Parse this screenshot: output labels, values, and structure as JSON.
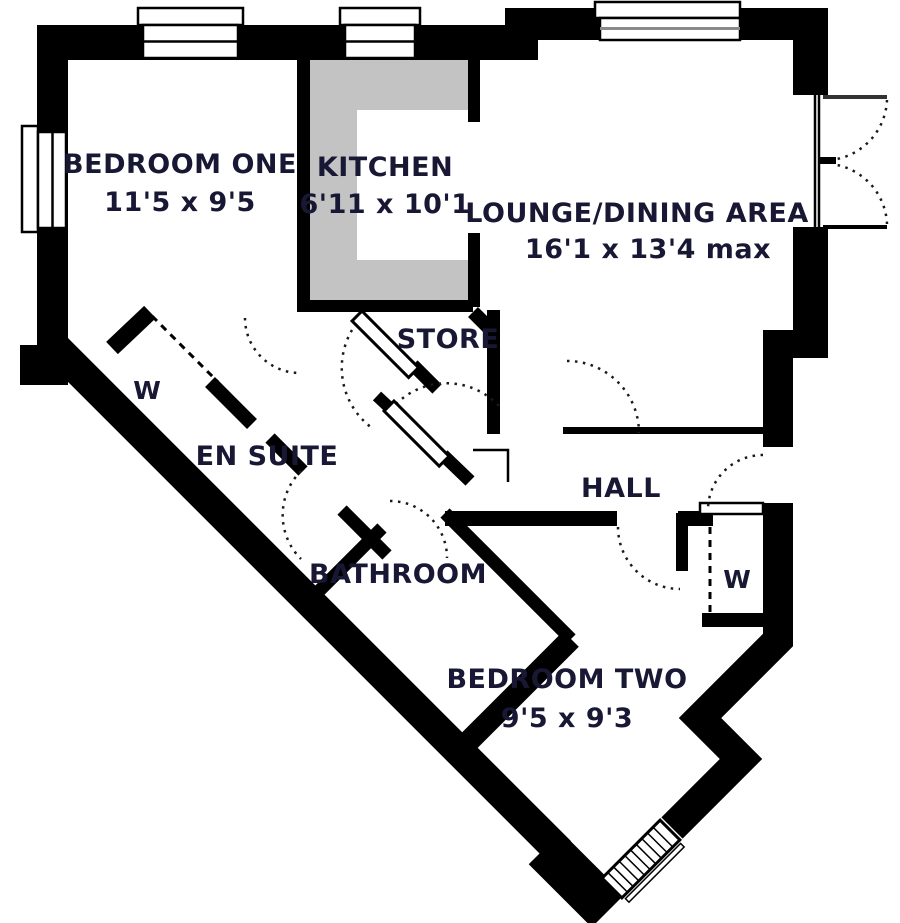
{
  "floorplan": {
    "rooms": {
      "bedroom_one": {
        "name": "BEDROOM ONE",
        "dimensions": "11'5 x 9'5"
      },
      "kitchen": {
        "name": "KITCHEN",
        "dimensions": "6'11 x 10'1"
      },
      "lounge": {
        "name": "LOUNGE/DINING AREA",
        "dimensions": "16'1 x 13'4 max"
      },
      "store": {
        "name": "STORE"
      },
      "en_suite": {
        "name": "EN SUITE"
      },
      "hall": {
        "name": "HALL"
      },
      "bathroom": {
        "name": "BATHROOM"
      },
      "bedroom_two": {
        "name": "BEDROOM TWO",
        "dimensions": "9'5 x 9'3"
      },
      "wardrobe_one": {
        "name": "W"
      },
      "wardrobe_two": {
        "name": "W"
      }
    },
    "colors": {
      "wall": "#000000",
      "counter": "#c3c3c3",
      "text": "#181835",
      "background": "#ffffff"
    }
  }
}
